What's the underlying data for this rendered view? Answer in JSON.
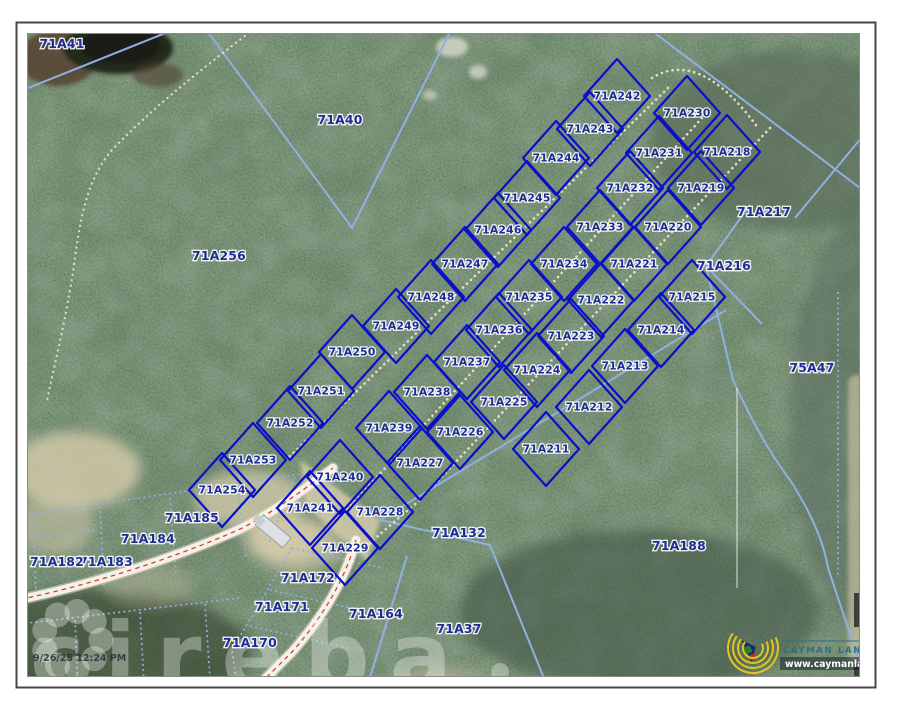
{
  "page": {
    "timestamp": "9/26/25 12:24 PM"
  },
  "watermark": {
    "text": "cireba"
  },
  "branding": {
    "name": "CAYMAN LAND INFO",
    "url": "www.caymanlandinfo.ky"
  },
  "map": {
    "colors": {
      "selected_boundary": "#0a10c8",
      "context_boundary": "#8fb0e2",
      "label": "#1e2d96",
      "road_centerline": "#d63a2a",
      "trail": "#ece2c8",
      "watermark": "rgba(246,248,244,0.34)"
    },
    "selected_parcels": [
      {
        "label": "71A242",
        "x": 617,
        "y": 96
      },
      {
        "label": "71A243",
        "x": 590,
        "y": 129
      },
      {
        "label": "71A244",
        "x": 556,
        "y": 158
      },
      {
        "label": "71A245",
        "x": 527,
        "y": 198
      },
      {
        "label": "71A246",
        "x": 498,
        "y": 230
      },
      {
        "label": "71A247",
        "x": 465,
        "y": 264
      },
      {
        "label": "71A248",
        "x": 431,
        "y": 297
      },
      {
        "label": "71A249",
        "x": 396,
        "y": 326
      },
      {
        "label": "71A250",
        "x": 352,
        "y": 352
      },
      {
        "label": "71A251",
        "x": 321,
        "y": 391
      },
      {
        "label": "71A252",
        "x": 290,
        "y": 423
      },
      {
        "label": "71A253",
        "x": 253,
        "y": 460
      },
      {
        "label": "71A254",
        "x": 222,
        "y": 490
      },
      {
        "label": "71A230",
        "x": 687,
        "y": 113
      },
      {
        "label": "71A231",
        "x": 659,
        "y": 153
      },
      {
        "label": "71A232",
        "x": 630,
        "y": 188
      },
      {
        "label": "71A233",
        "x": 600,
        "y": 227
      },
      {
        "label": "71A234",
        "x": 564,
        "y": 264
      },
      {
        "label": "71A235",
        "x": 529,
        "y": 297
      },
      {
        "label": "71A236",
        "x": 499,
        "y": 330
      },
      {
        "label": "71A237",
        "x": 467,
        "y": 362
      },
      {
        "label": "71A238",
        "x": 427,
        "y": 392
      },
      {
        "label": "71A239",
        "x": 389,
        "y": 428
      },
      {
        "label": "71A240",
        "x": 340,
        "y": 477
      },
      {
        "label": "71A241",
        "x": 310,
        "y": 508
      },
      {
        "label": "71A218",
        "x": 727,
        "y": 152
      },
      {
        "label": "71A219",
        "x": 701,
        "y": 188
      },
      {
        "label": "71A220",
        "x": 668,
        "y": 227
      },
      {
        "label": "71A221",
        "x": 634,
        "y": 264
      },
      {
        "label": "71A222",
        "x": 601,
        "y": 300
      },
      {
        "label": "71A223",
        "x": 571,
        "y": 336
      },
      {
        "label": "71A224",
        "x": 537,
        "y": 370
      },
      {
        "label": "71A225",
        "x": 504,
        "y": 402
      },
      {
        "label": "71A226",
        "x": 460,
        "y": 432
      },
      {
        "label": "71A227",
        "x": 420,
        "y": 463
      },
      {
        "label": "71A228",
        "x": 380,
        "y": 512
      },
      {
        "label": "71A229",
        "x": 345,
        "y": 548
      },
      {
        "label": "71A215",
        "x": 692,
        "y": 297
      },
      {
        "label": "71A214",
        "x": 661,
        "y": 330
      },
      {
        "label": "71A213",
        "x": 625,
        "y": 366
      },
      {
        "label": "71A212",
        "x": 589,
        "y": 407
      },
      {
        "label": "71A211",
        "x": 546,
        "y": 449
      }
    ],
    "context_parcels": [
      {
        "label": "71A41",
        "x": 62,
        "y": 44
      },
      {
        "label": "71A40",
        "x": 340,
        "y": 120
      },
      {
        "label": "71A256",
        "x": 219,
        "y": 256
      },
      {
        "label": "75A47",
        "x": 812,
        "y": 368
      },
      {
        "label": "71A217",
        "x": 764,
        "y": 212
      },
      {
        "label": "71A216",
        "x": 724,
        "y": 266
      },
      {
        "label": "71A185",
        "x": 192,
        "y": 518
      },
      {
        "label": "71A184",
        "x": 148,
        "y": 539
      },
      {
        "label": "71A183",
        "x": 106,
        "y": 562
      },
      {
        "label": "71A182",
        "x": 57,
        "y": 562
      },
      {
        "label": "71A172",
        "x": 308,
        "y": 578
      },
      {
        "label": "71A171",
        "x": 282,
        "y": 607
      },
      {
        "label": "71A170",
        "x": 250,
        "y": 643
      },
      {
        "label": "71A164",
        "x": 376,
        "y": 614
      },
      {
        "label": "71A132",
        "x": 459,
        "y": 533
      },
      {
        "label": "71A37",
        "x": 459,
        "y": 629
      },
      {
        "label": "71A188",
        "x": 679,
        "y": 546
      }
    ]
  }
}
